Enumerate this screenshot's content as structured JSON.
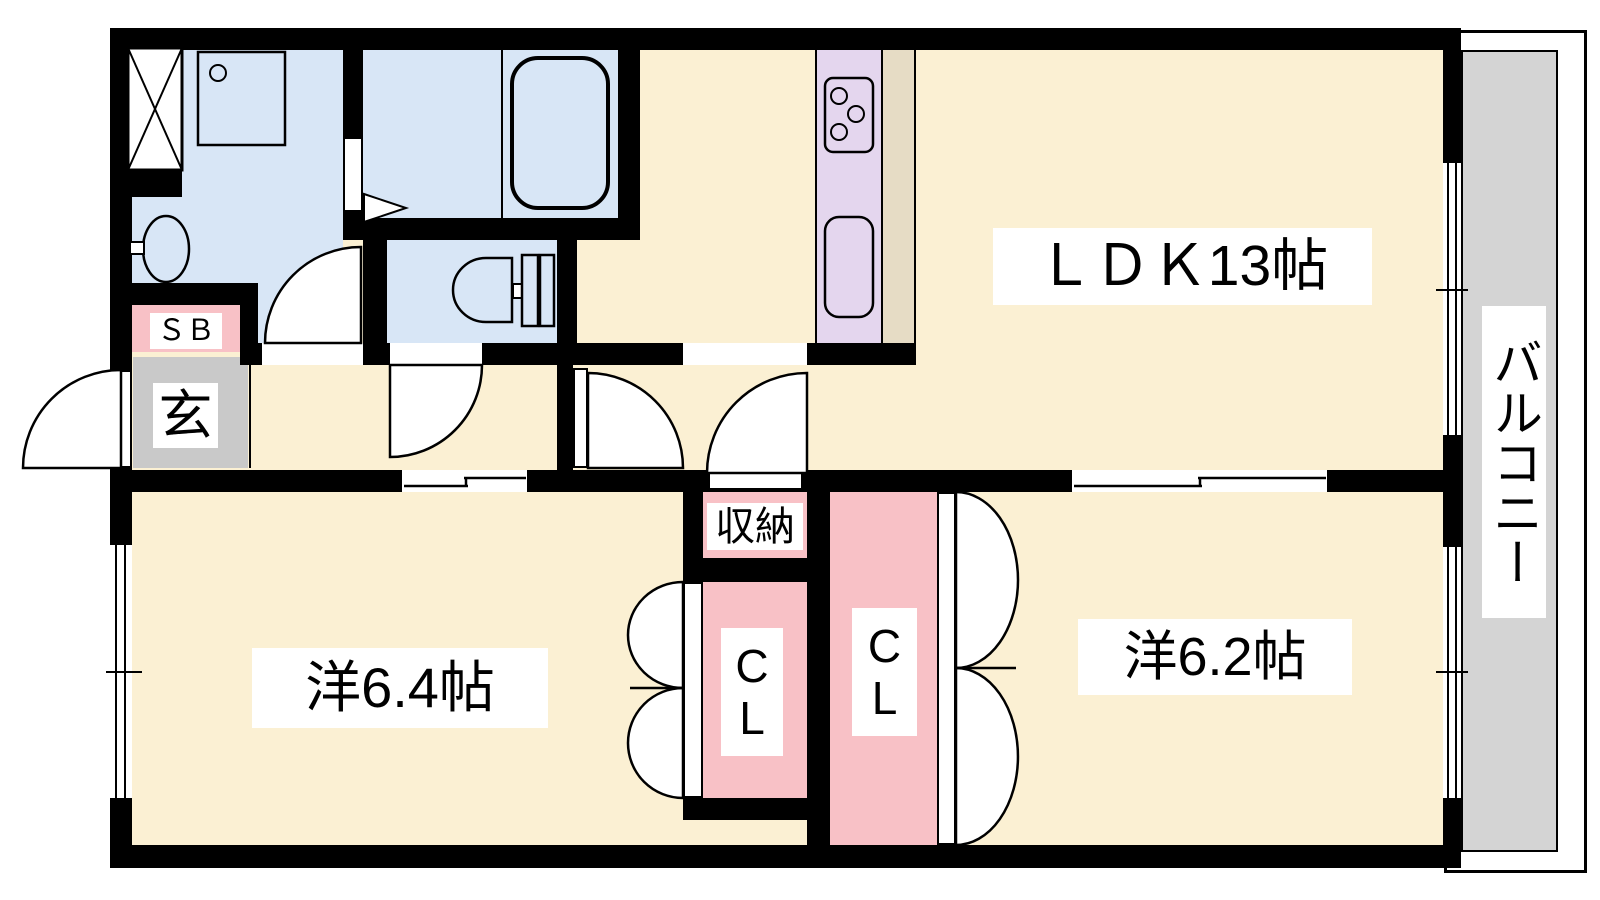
{
  "floorplan": {
    "type": "apartment-floor-plan",
    "rooms": {
      "ldk": {
        "label": "ＬＤＫ13帖"
      },
      "western_room_left": {
        "label": "洋6.4帖"
      },
      "western_room_right": {
        "label": "洋6.2帖"
      },
      "balcony": {
        "label": "バルコニー"
      },
      "entrance": {
        "label": "玄"
      },
      "shoe_box": {
        "label": "ＳＢ"
      },
      "storage": {
        "label": "収納"
      },
      "closet_left": {
        "label": "CL"
      },
      "closet_right": {
        "label": "CL"
      }
    },
    "fixtures": [
      "washing-machine-pan",
      "washstand-counter",
      "wash-basin",
      "bathtub",
      "toilet",
      "gas-stove",
      "kitchen-sink"
    ],
    "colors": {
      "wall": "#000000",
      "room_floor": "#fbf0d3",
      "wet_area": "#d8e6f6",
      "closet_pink": "#f8c1c6",
      "kitchen_counter": "#e4d6ee",
      "kitchen_floor": "#e6dcc5",
      "entrance_floor": "#c9c9c9",
      "balcony_floor": "#d4d4d4",
      "label_background": "#ffffff",
      "label_text": "#000000"
    }
  }
}
